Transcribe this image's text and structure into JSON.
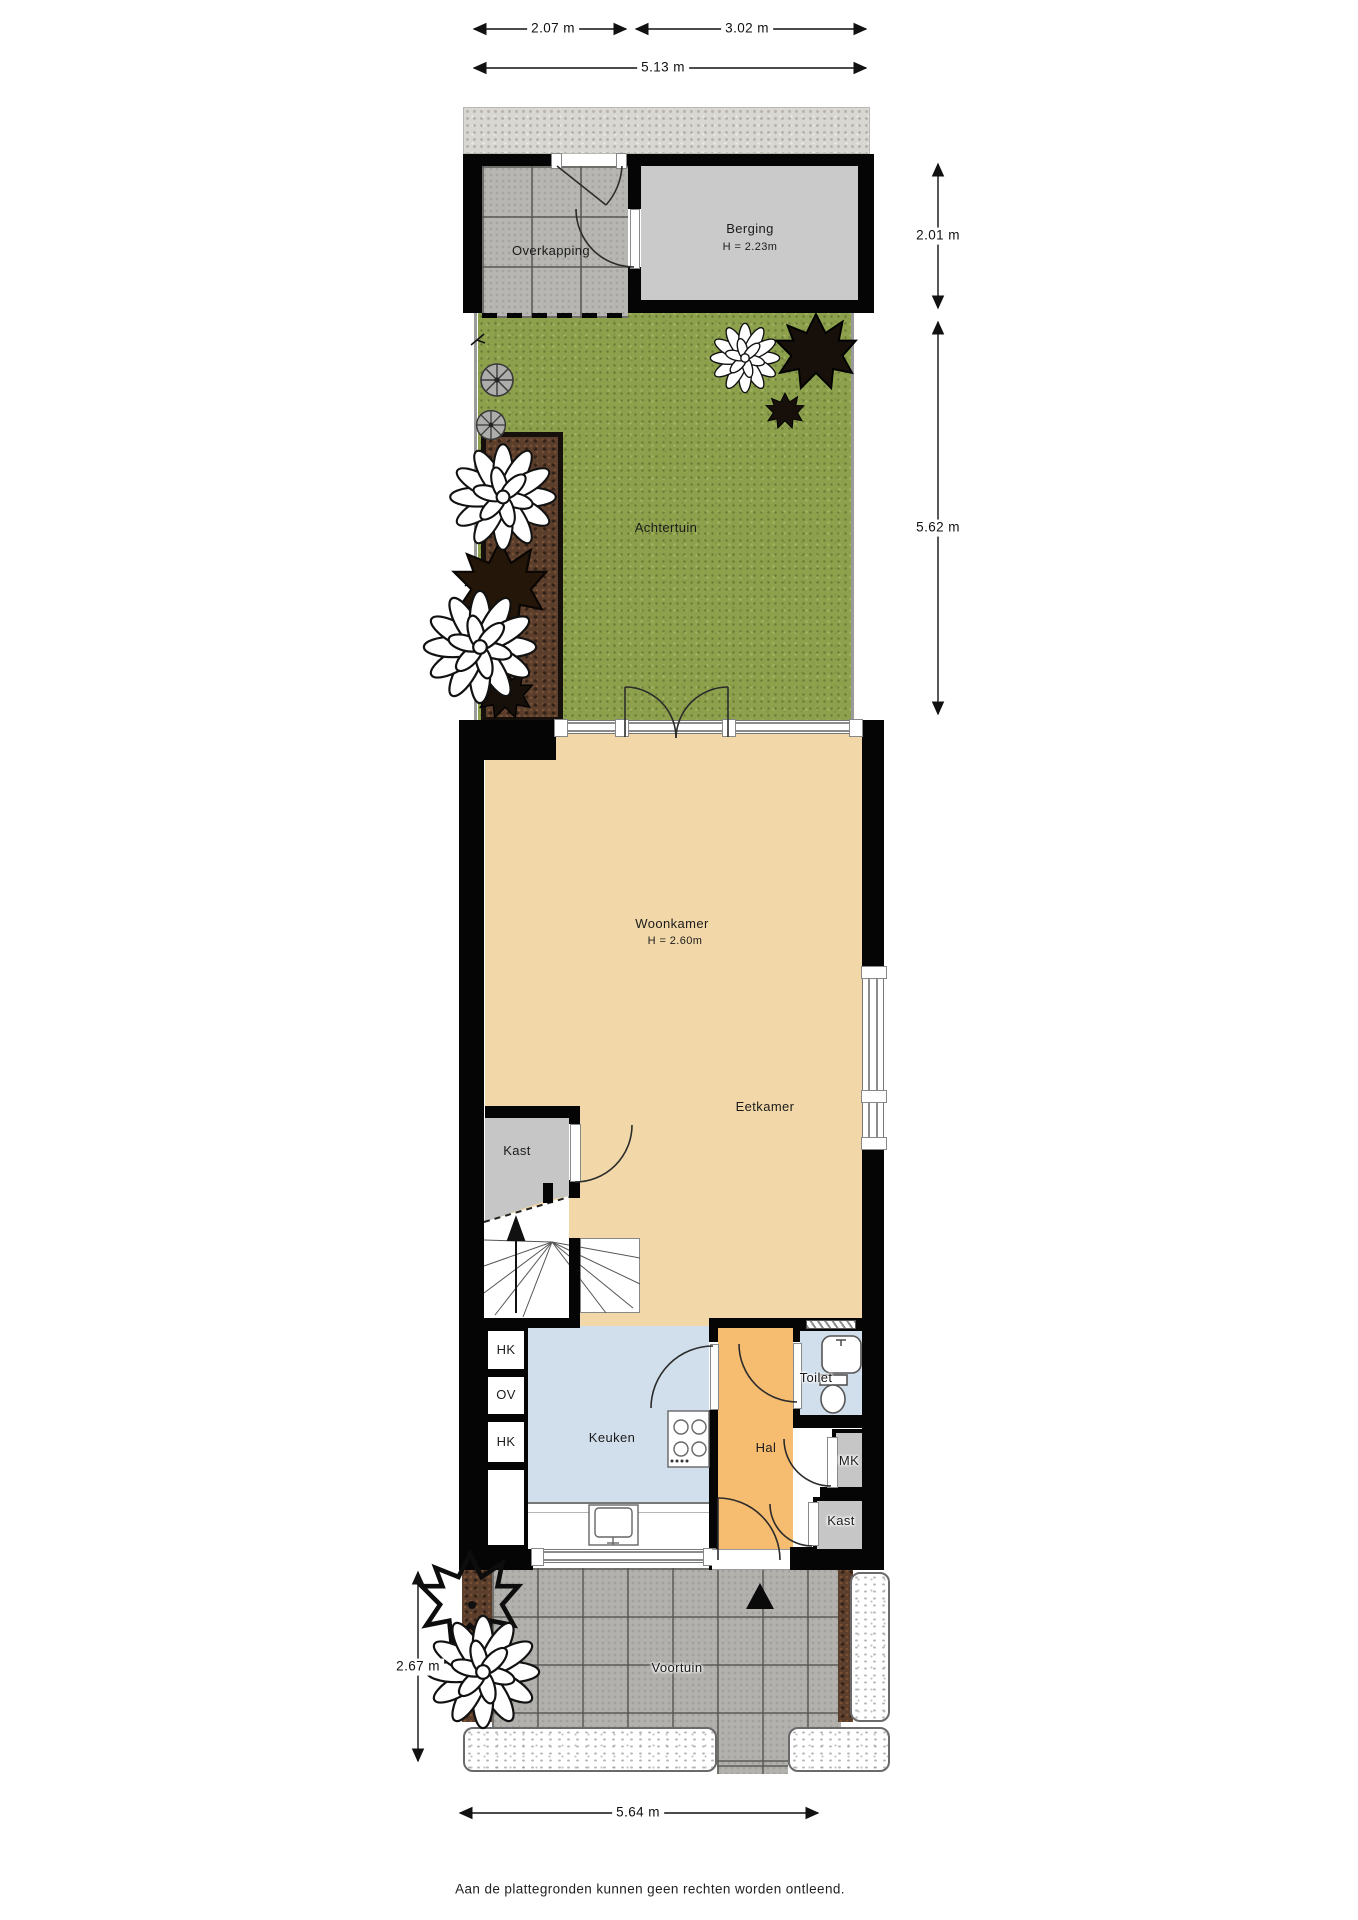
{
  "plan": {
    "footer": "Aan de plattegronden kunnen geen rechten worden ontleend.",
    "dimensions": {
      "top_left": "2.07 m",
      "top_right": "3.02 m",
      "top_total": "5.13 m",
      "right_upper": "2.01 m",
      "right_lower": "5.62 m",
      "front_left": "2.67 m",
      "bottom_total": "5.64 m"
    },
    "rooms": {
      "overkapping": "Overkapping",
      "berging": "Berging",
      "berging_height": "H = 2.23m",
      "achtertuin": "Achtertuin",
      "woonkamer": "Woonkamer",
      "woonkamer_height": "H = 2.60m",
      "eetkamer": "Eetkamer",
      "kast_upper": "Kast",
      "hk_top": "HK",
      "ov": "OV",
      "hk_bottom": "HK",
      "keuken": "Keuken",
      "hal": "Hal",
      "toilet": "Toilet",
      "mk": "MK",
      "kast_lower": "Kast",
      "voortuin": "Voortuin"
    },
    "colors": {
      "floor_living": "#f2d8a8",
      "floor_kitchen": "#d0dfeb",
      "floor_hall": "#f6bc70",
      "storage_grey": "#cacaca",
      "grass": "#8da14d",
      "soil": "#5b3e2c",
      "wall": "#050505"
    }
  }
}
